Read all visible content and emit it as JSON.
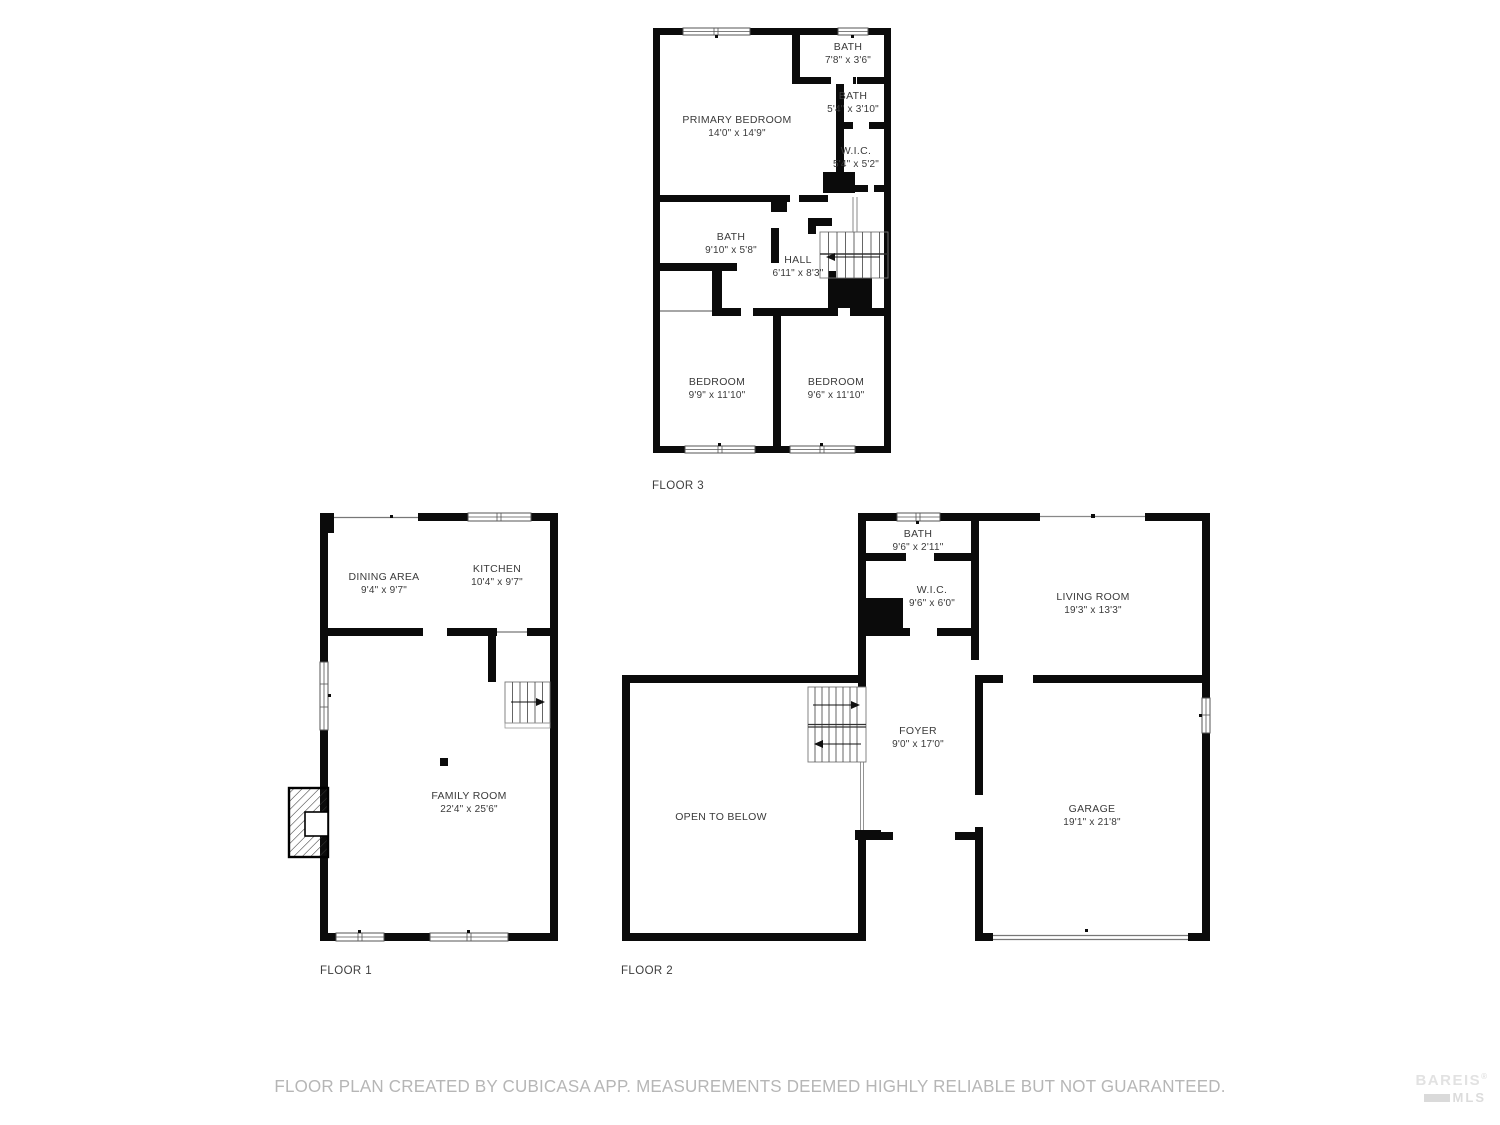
{
  "floors": {
    "floor3": {
      "label": "FLOOR 3",
      "rooms": {
        "primary": {
          "name": "PRIMARY BEDROOM",
          "dims": "14'0\" x 14'9\""
        },
        "bath_top": {
          "name": "BATH",
          "dims": "7'8\" x 3'6\""
        },
        "bath_mid": {
          "name": "BATH",
          "dims": "5'4\" x 3'10\""
        },
        "wic": {
          "name": "W.I.C.",
          "dims": "5'4\" x 5'2\""
        },
        "bath_main": {
          "name": "BATH",
          "dims": "9'10\" x 5'8\""
        },
        "hall": {
          "name": "HALL",
          "dims": "6'11\" x 8'3\""
        },
        "bedroom_left": {
          "name": "BEDROOM",
          "dims": "9'9\" x 11'10\""
        },
        "bedroom_right": {
          "name": "BEDROOM",
          "dims": "9'6\" x 11'10\""
        }
      }
    },
    "floor1": {
      "label": "FLOOR 1",
      "rooms": {
        "dining": {
          "name": "DINING AREA",
          "dims": "9'4\" x 9'7\""
        },
        "kitchen": {
          "name": "KITCHEN",
          "dims": "10'4\" x 9'7\""
        },
        "family": {
          "name": "FAMILY ROOM",
          "dims": "22'4\" x 25'6\""
        }
      }
    },
    "floor2": {
      "label": "FLOOR 2",
      "rooms": {
        "bath": {
          "name": "BATH",
          "dims": "9'6\" x 2'11\""
        },
        "wic": {
          "name": "W.I.C.",
          "dims": "9'6\" x 6'0\""
        },
        "living": {
          "name": "LIVING ROOM",
          "dims": "19'3\" x 13'3\""
        },
        "foyer": {
          "name": "FOYER",
          "dims": "9'0\" x 17'0\""
        },
        "open_below": {
          "name": "OPEN TO BELOW"
        },
        "garage": {
          "name": "GARAGE",
          "dims": "19'1\" x 21'8\""
        }
      }
    }
  },
  "footer": {
    "disclaimer": "FLOOR PLAN CREATED BY CUBICASA APP. MEASUREMENTS DEEMED HIGHLY RELIABLE BUT NOT GUARANTEED.",
    "logo_line1": "BAREIS",
    "logo_reg": "®",
    "logo_line2": "MLS"
  },
  "colors": {
    "wall": "#0b0b0b",
    "room_text": "#3a3a3a",
    "disclaimer_text": "#b6b6b6",
    "logo_text": "#e2e2e2"
  }
}
